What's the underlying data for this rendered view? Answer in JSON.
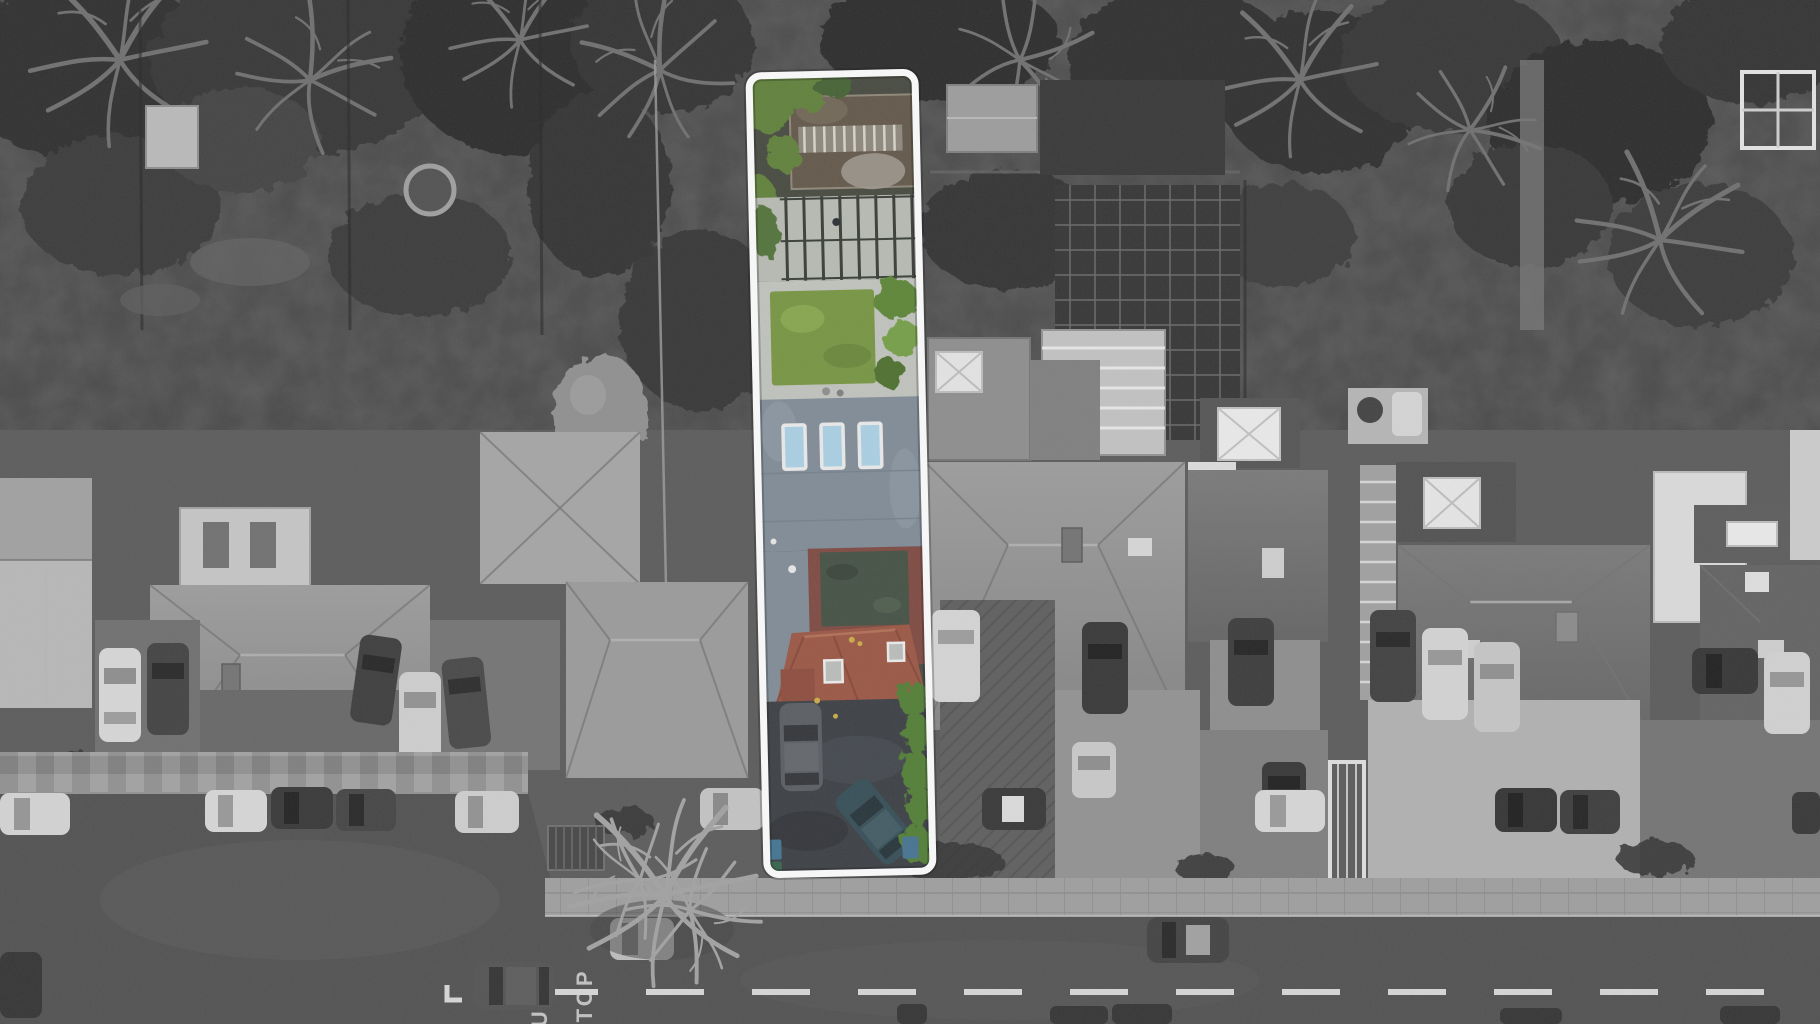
{
  "street": {
    "markings": {
      "bus": "BUS",
      "stop": "STOP"
    }
  },
  "road": {
    "marking_paint": "#d8d8d8"
  },
  "highlight": {
    "outline": "#ffffff",
    "lawn": "#72923a",
    "shrubs": "#5a7d33",
    "hedge": "#4c7a2e",
    "flat_roof": "#7c8894",
    "skylight_glass": "#a9d0e6",
    "red_roof": "#99503c",
    "maroon_roof": "#79423a",
    "green_roof_inset": "#3c4a3c",
    "driveway": "#33373c",
    "teal_car": "#2e4750",
    "blue_bin": "#3f6e8e",
    "flowers": "#c9a93f"
  }
}
